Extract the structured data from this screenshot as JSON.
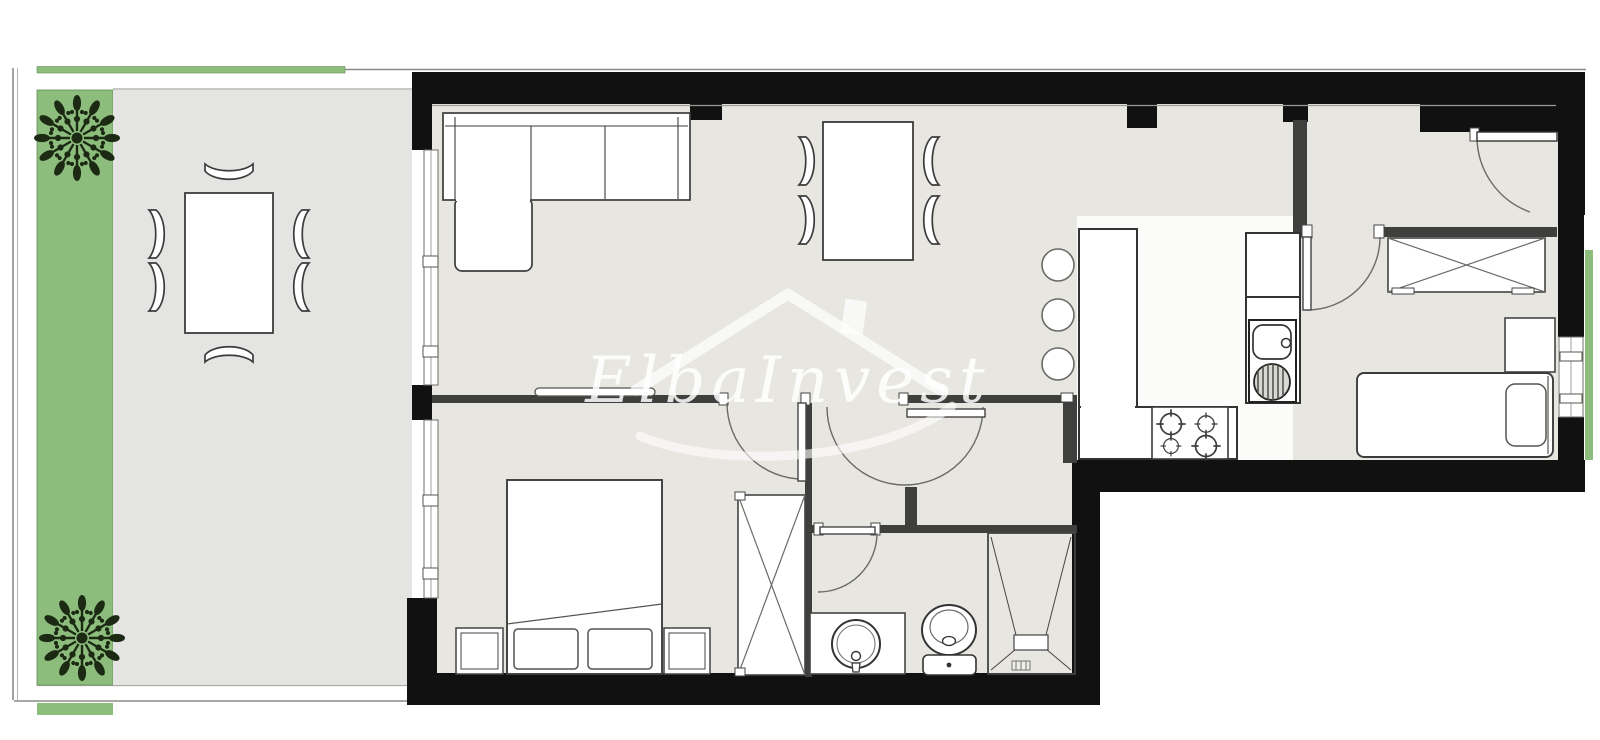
{
  "watermark": {
    "text": "ElbaInvest"
  },
  "colors": {
    "garden_green": "#8dbd7d",
    "terrace_gray": "#e4e4e3",
    "floor_beige": "#e8e6e0",
    "kitchen_white": "#fbfbfa",
    "wall_exterior": "#111111",
    "wall_interior": "#3f3f3d",
    "line_gray": "#8a8a86",
    "plant_dark_green": "#1c2a14"
  },
  "rooms": [
    {
      "id": "garden-strip",
      "furniture": [
        "plant-1",
        "plant-2"
      ]
    },
    {
      "id": "terrace",
      "furniture": [
        "outdoor-dining-table",
        "terrace-chairs-x6"
      ]
    },
    {
      "id": "living-room",
      "furniture": [
        "corner-sofa",
        "tv-shelf",
        "dining-table",
        "dining-chairs-x4"
      ]
    },
    {
      "id": "kitchen",
      "furniture": [
        "peninsula-counter",
        "bar-stools-x3",
        "stove-4-burners",
        "sink-unit",
        "fridge-cabinet"
      ]
    },
    {
      "id": "entrance-hall",
      "furniture": [
        "entrance-door",
        "wardrobe"
      ]
    },
    {
      "id": "bedroom-main",
      "furniture": [
        "double-bed",
        "nightstand-left",
        "nightstand-right",
        "closet"
      ]
    },
    {
      "id": "bedroom-single",
      "furniture": [
        "single-bed",
        "desk"
      ]
    },
    {
      "id": "bathroom",
      "furniture": [
        "vanity-washbasin",
        "toilet",
        "shower"
      ]
    }
  ]
}
